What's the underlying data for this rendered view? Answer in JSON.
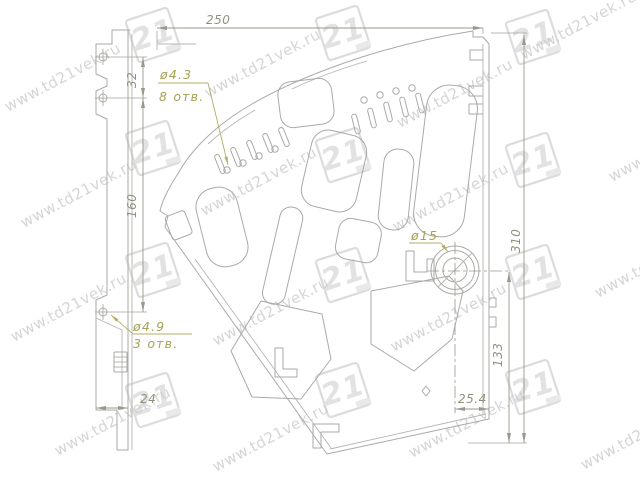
{
  "watermark": {
    "text": "www.td21vek.ru",
    "logo_text": "21"
  },
  "dimensions": {
    "top_width": "250",
    "hole_pitch": "32",
    "hole_span": "160",
    "side_bottom_width": "24",
    "right_height": "310",
    "hole_to_bottom": "133",
    "hole_to_edge": "25.4"
  },
  "annotations": {
    "plate_holes": {
      "diameter": "ø4.3",
      "count": "8 отв."
    },
    "side_holes": {
      "diameter": "ø4.9",
      "count": "3 отв."
    },
    "center_hole": {
      "diameter": "ø15"
    }
  },
  "colors": {
    "outline": "#aaaaa7",
    "dimension": "#9a998d",
    "annotation": "#a8a155",
    "watermark": "#cbcbcb"
  }
}
